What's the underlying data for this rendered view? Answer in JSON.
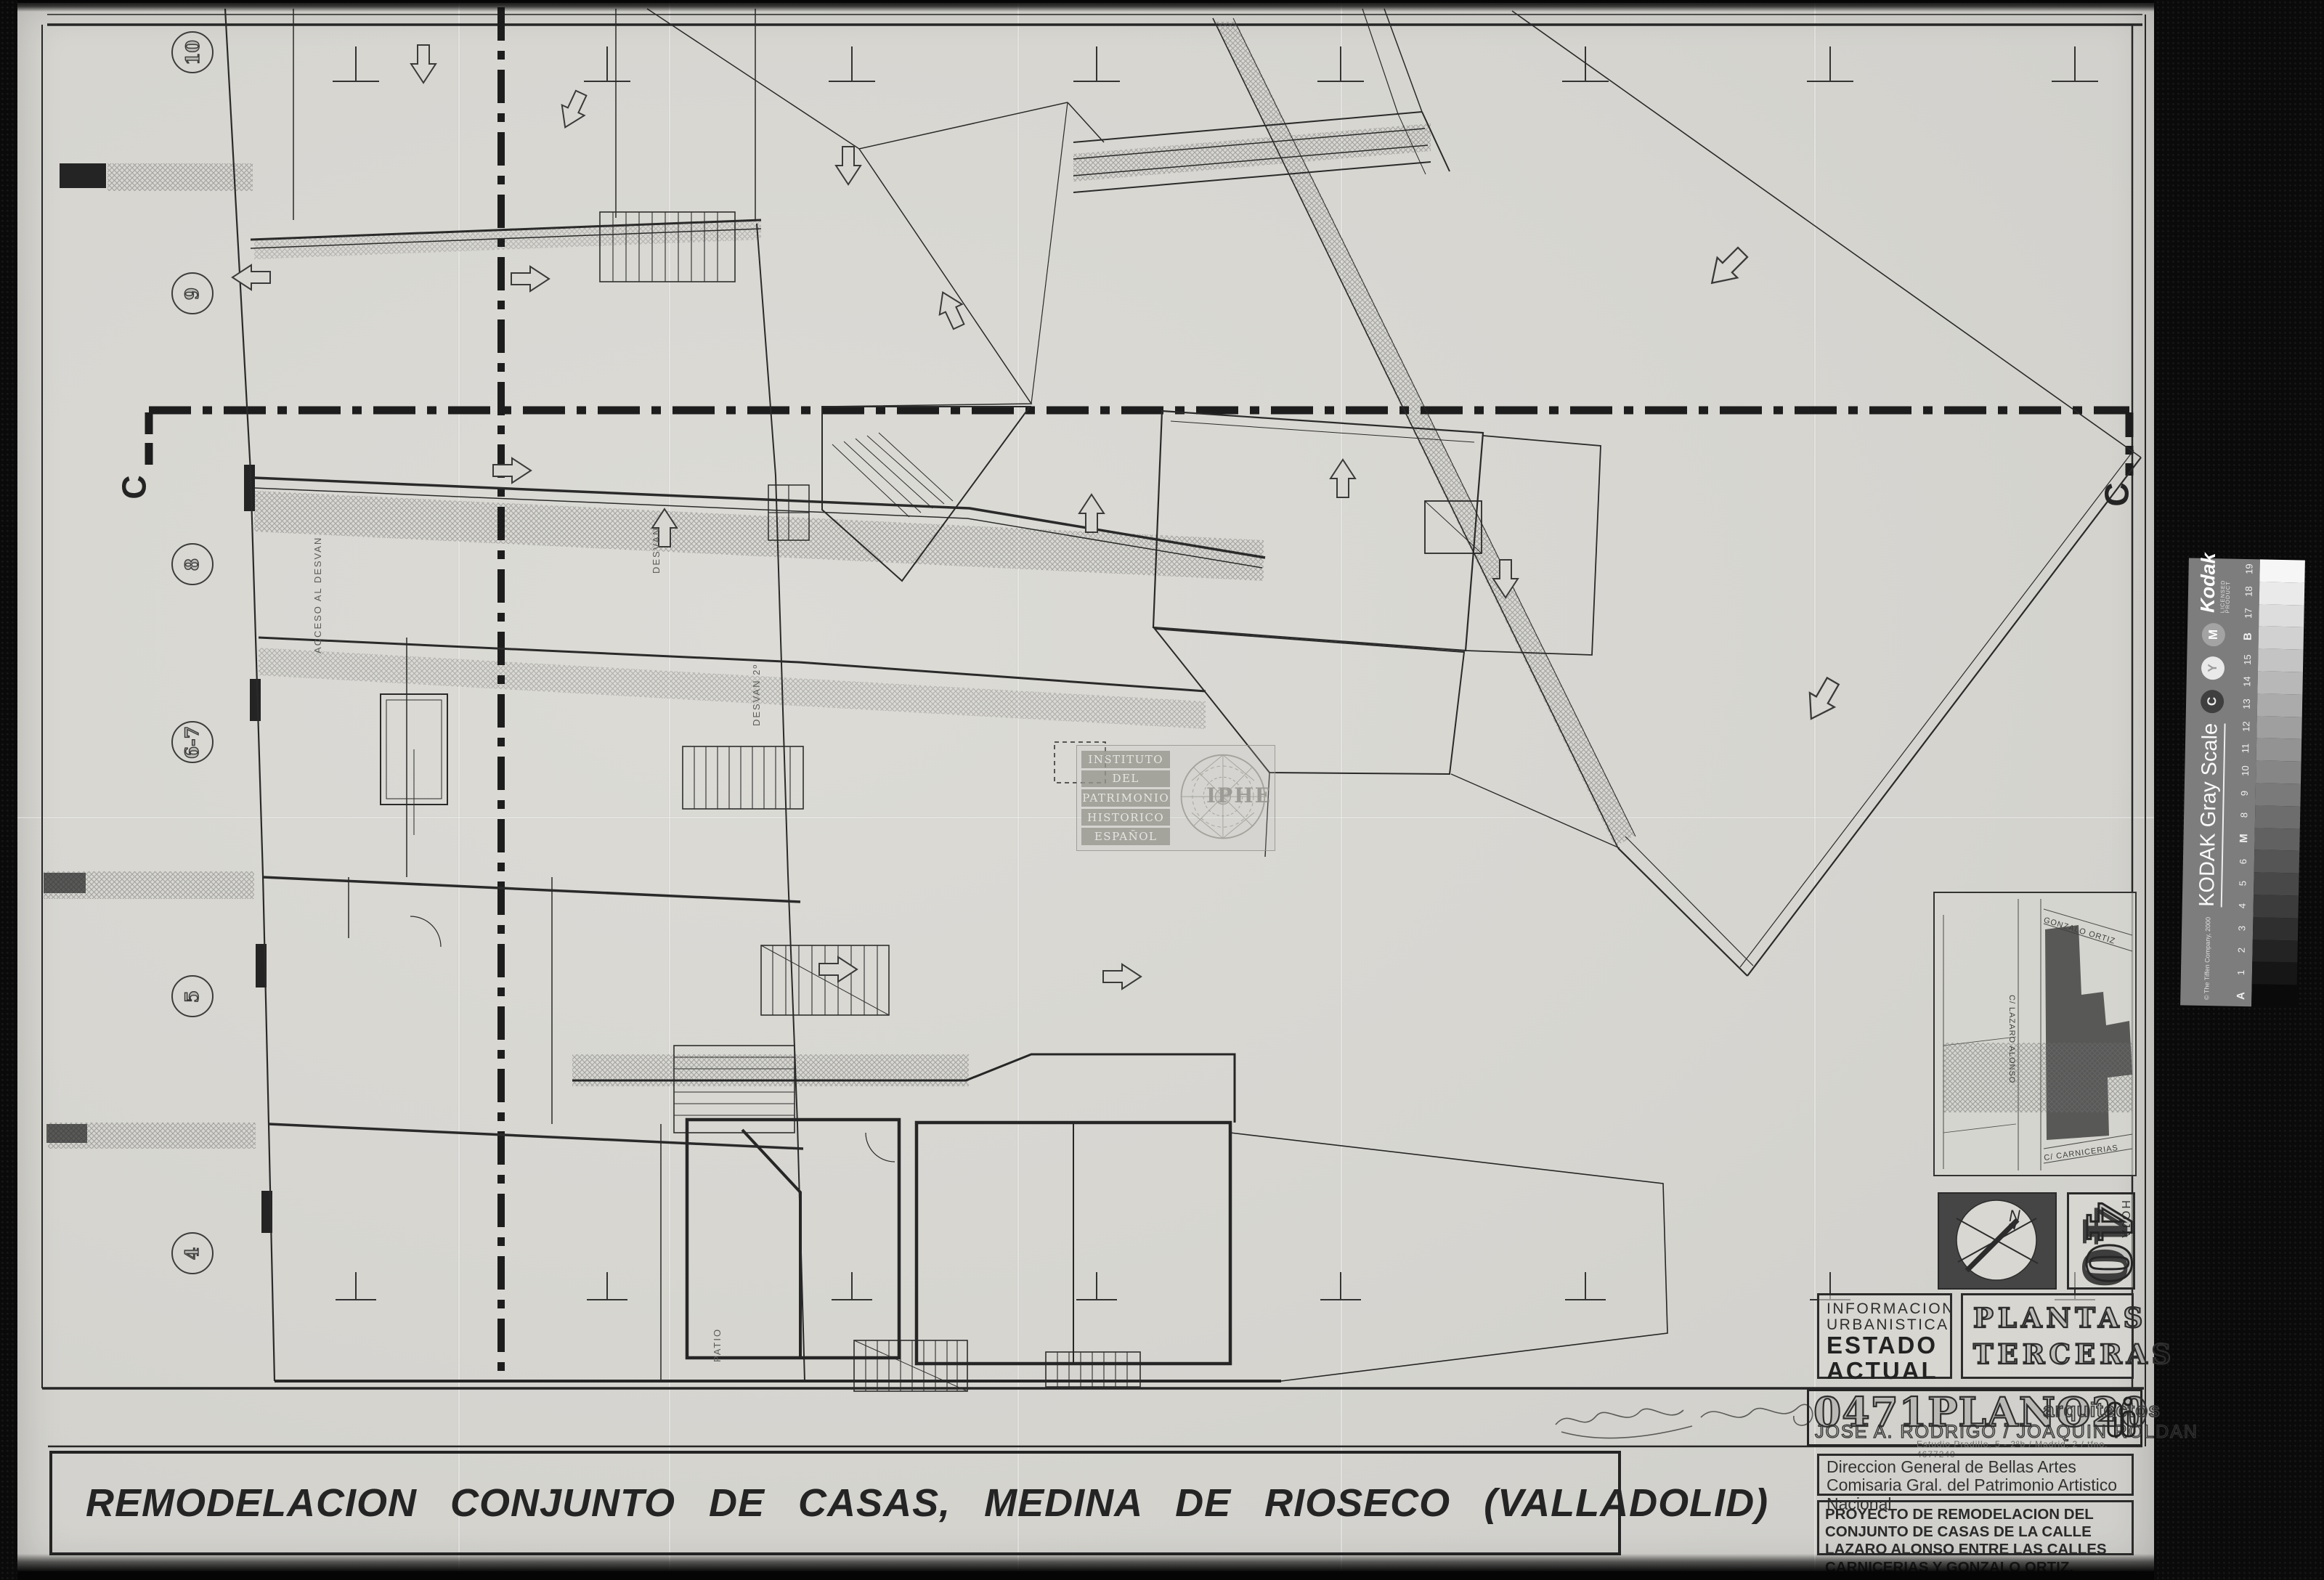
{
  "document": {
    "main_title": "REMODELACION CONJUNTO DE CASAS, MEDINA DE RIOSECO (VALLADOLID)",
    "title_block": {
      "code": "0471",
      "plano_word": "PLANO",
      "plano_number": "20",
      "profession": "arquitectos",
      "architects": "JOSE A. RODRIGO / JOAQUIN ROLDAN",
      "studio_line": "Estudio Pradillo, 5 - 2ºb / Madrid, 2 / tfno. 4677240"
    },
    "status_box": {
      "line1": "INFORMACION",
      "line2": "URBANISTICA",
      "line3": "ESTADO",
      "line4": "ACTUAL"
    },
    "drawing_type_box": {
      "line1": "PLANTAS",
      "line2": "TERCERAS"
    },
    "authority_box": {
      "line1": "Direccion General de Bellas Artes",
      "line2": "Comisaria Gral. del Patrimonio Artistico Nacional"
    },
    "project_box": {
      "text": "PROYECTO DE REMODELACION DEL CONJUNTO DE CASAS DE LA CALLE LAZARO ALONSO ENTRE LAS CALLES CARNICERIAS Y GONZALO ORTIZ."
    },
    "hoja": {
      "label": "HOJA",
      "number": "40"
    },
    "compass_north": "N"
  },
  "plan": {
    "grid_bubbles": [
      "10",
      "9",
      "8",
      "6-7",
      "5",
      "4"
    ],
    "section_marker": "C",
    "room_labels": {
      "desvan": "DESVAN",
      "desvan2": "DESVAN 2º",
      "acceso": "ACCESO AL DESVAN",
      "patio": "PATIO"
    }
  },
  "inset_map": {
    "street_top": "GONZALO ORTIZ",
    "street_left": "C/ LAZARO ALONSO",
    "street_bottom": "C/ CARNICERIAS"
  },
  "watermark": {
    "lines": [
      "INSTITUTO",
      "DEL",
      "PATRIMONIO",
      "HISTORICO",
      "ESPAÑOL"
    ],
    "acronym": "IPHE"
  },
  "kodak_strip": {
    "brand": "Kodak",
    "licensed": "LICENSED PRODUCT",
    "title": "KODAK Gray Scale",
    "copyright": "© The Tiffen Company, 2000",
    "cmy": [
      "C",
      "Y",
      "M"
    ],
    "scale_labels": [
      "A",
      "1",
      "2",
      "3",
      "4",
      "5",
      "6",
      "M",
      "8",
      "9",
      "10",
      "11",
      "12",
      "13",
      "14",
      "15",
      "B",
      "17",
      "18",
      "19"
    ]
  },
  "colors": {
    "paper": "#d8d7d2",
    "ink": "#222222",
    "background": "#0a0a0a",
    "kodak_band": "#7d7d7d"
  }
}
